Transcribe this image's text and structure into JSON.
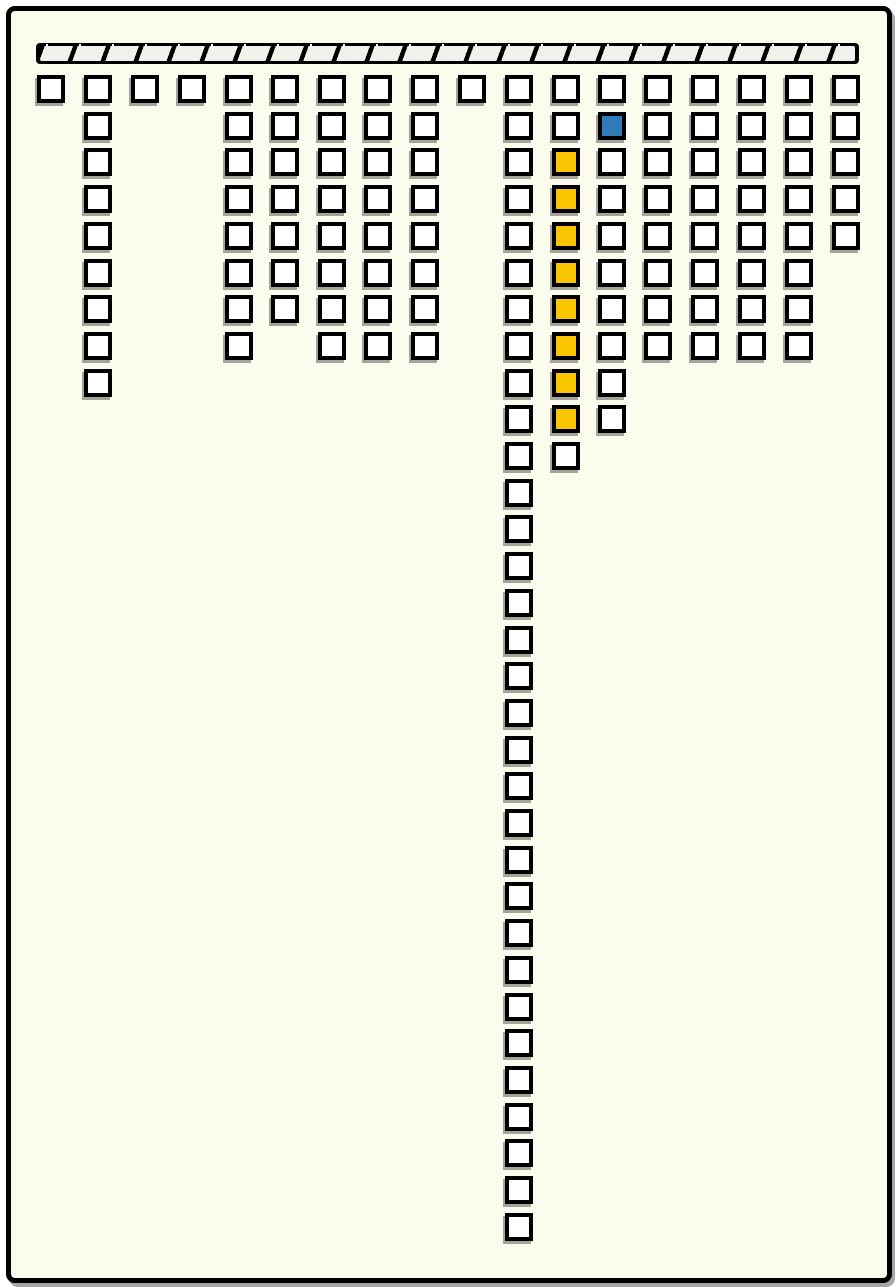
{
  "board": {
    "frame": {
      "x": 6,
      "y": 6,
      "width": 886,
      "height": 1277,
      "border_width": 5,
      "border_color": "#000000",
      "fill": "#fcfcee",
      "corner_radius": 9
    },
    "top_bar": {
      "x": 36,
      "y": 43,
      "width": 823,
      "height": 21,
      "segment_count": 25,
      "segment_pitch": 33,
      "bar_color": "#000000",
      "segment_fill": "#f1f1ec",
      "divider_color": "#000000",
      "dot_color": "#ffffff"
    },
    "grid": {
      "cell_size": 28,
      "cell_border_color": "#000000",
      "origin_y": 75,
      "row_pitch": 36.7,
      "total_cells": 142,
      "colors": {
        "default": "#ffffff",
        "highlight": "#f9c400",
        "selected": "#2f7cba"
      },
      "columns": [
        {
          "x": 37,
          "count": 1
        },
        {
          "x": 84,
          "count": 9
        },
        {
          "x": 131,
          "count": 1
        },
        {
          "x": 178,
          "count": 1
        },
        {
          "x": 225,
          "count": 8
        },
        {
          "x": 271,
          "count": 7
        },
        {
          "x": 318,
          "count": 8
        },
        {
          "x": 364,
          "count": 8
        },
        {
          "x": 411,
          "count": 8
        },
        {
          "x": 458,
          "count": 1
        },
        {
          "x": 505,
          "count": 32
        },
        {
          "x": 552,
          "count": 11
        },
        {
          "x": 598,
          "count": 10
        },
        {
          "x": 644,
          "count": 8
        },
        {
          "x": 691,
          "count": 8
        },
        {
          "x": 738,
          "count": 8
        },
        {
          "x": 785,
          "count": 8
        },
        {
          "x": 832,
          "count": 5
        }
      ],
      "special_cells": [
        {
          "col": 12,
          "rows": [
            3,
            4,
            5,
            6,
            7,
            8,
            9,
            10
          ],
          "color": "highlight"
        },
        {
          "col": 13,
          "rows": [
            2
          ],
          "color": "selected"
        }
      ]
    }
  }
}
